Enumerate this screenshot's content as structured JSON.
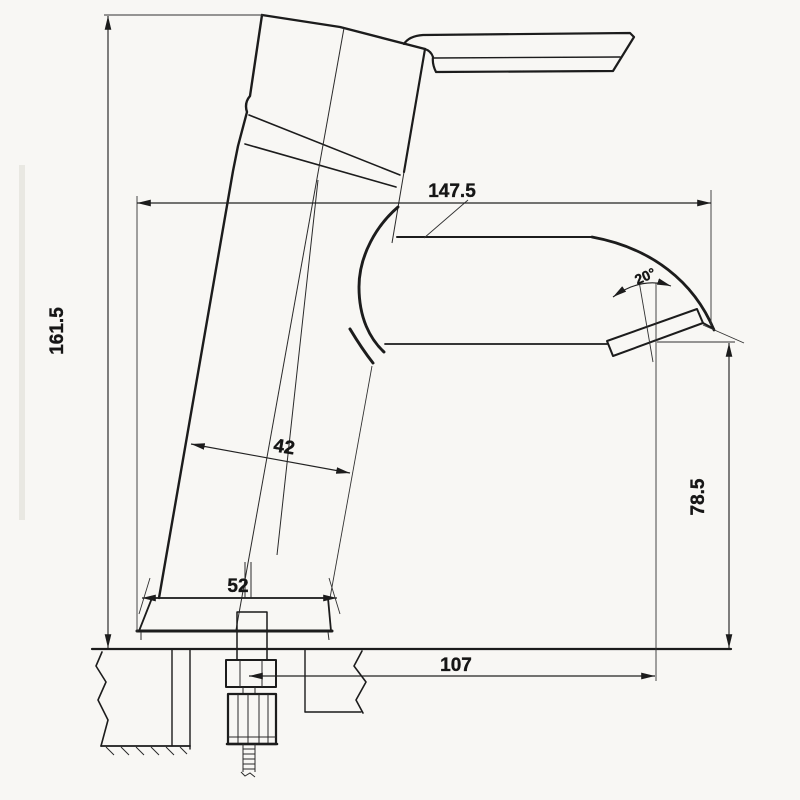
{
  "drawing": {
    "background_color": "#f8f7f4",
    "line_color": "#1c1c1c",
    "dimensions": {
      "overall_width": {
        "label": "147.5"
      },
      "overall_height": {
        "label": "161.5"
      },
      "body_diameter": {
        "label": "42"
      },
      "base_width": {
        "label": "52"
      },
      "outlet_height": {
        "label": "78.5"
      },
      "spout_reach": {
        "label": "107"
      },
      "aerator_angle": {
        "label": "20°"
      }
    }
  }
}
